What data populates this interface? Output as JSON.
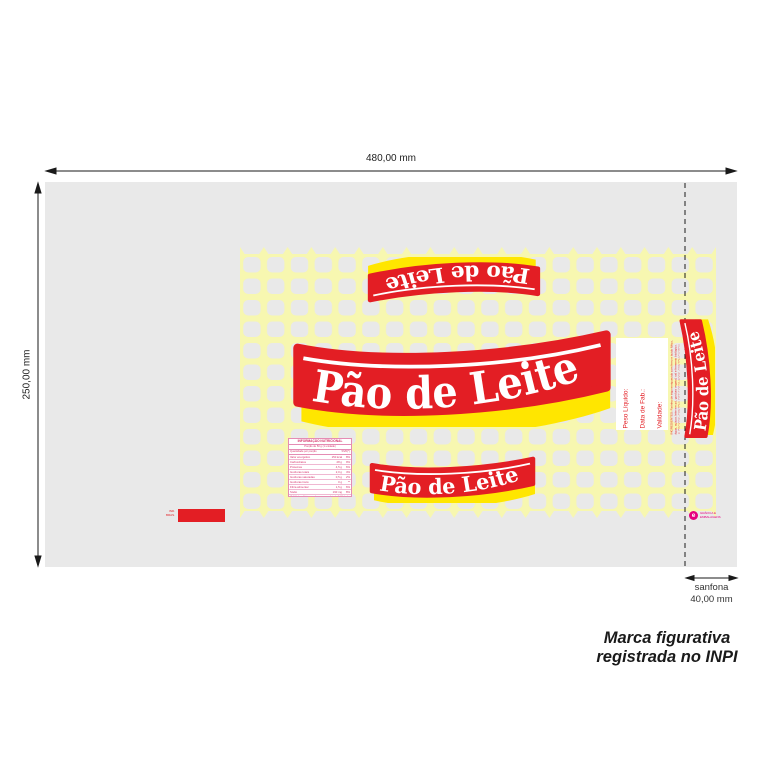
{
  "document": {
    "width_dim": "480,00 mm",
    "height_dim": "250,00 mm",
    "sanfona_label": "sanfona",
    "sanfona_dim": "40,00 mm",
    "trademark": {
      "line1": "Marca figurativa",
      "line2": "registrada no INPI"
    }
  },
  "banner": {
    "text": "Pão de Leite"
  },
  "fill_panel": {
    "weight": "Peso Líquido:",
    "mfg_date": "Data de Fab.:",
    "validity": "Validade:"
  },
  "legal": {
    "ingredients": "INGREDIENTES: Farinha de trigo enriquecida com ferro e ácido fólico, água, açúcar, leite em pó, gordura vegetal, sal e fermento biológico.",
    "allergens": "ALÉRGICOS: CONTÉM LEITE E DERIVADOS. CONTÉM GLÚTEN."
  },
  "nutrition": {
    "title": "INFORMAÇÃO NUTRICIONAL",
    "serving": "Porção de 50 g (1 unidade)",
    "col_qty": "Quantidade por porção",
    "col_vd": "%VD(*)",
    "rows": [
      {
        "label": "Valor energético",
        "qty": "150 kcal",
        "vd": "8%"
      },
      {
        "label": "Carboidratos",
        "qty": "28 g",
        "vd": "9%"
      },
      {
        "label": "Proteínas",
        "qty": "4,5 g",
        "vd": "6%"
      },
      {
        "label": "Gorduras totais",
        "qty": "2,0 g",
        "vd": "4%"
      },
      {
        "label": "Gorduras saturadas",
        "qty": "0,5 g",
        "vd": "2%"
      },
      {
        "label": "Gorduras trans",
        "qty": "0 g",
        "vd": "**"
      },
      {
        "label": "Fibra alimentar",
        "qty": "1,5 g",
        "vd": "6%"
      },
      {
        "label": "Sódio",
        "qty": "190 mg",
        "vd": "8%"
      }
    ],
    "footnote": "(*) % Valores Diários com base em uma dieta de 2.000 kcal ou 8.400 kJ. Seus valores diários podem ser maiores ou menores dependendo de suas necessidades energéticas."
  },
  "small_print": {
    "line1": "IND.",
    "line2": "BRAS."
  },
  "printer": {
    "line1": "GRÁFICA E",
    "line2": "EMBALAGENS"
  },
  "colors": {
    "brand_red": "#e31e24",
    "brand_yellow": "#ffe600",
    "net_yellow": "#f7f7b0",
    "film_gray": "#e9e9e9",
    "table_pink": "#d6336c",
    "logo_magenta": "#e6007e"
  }
}
